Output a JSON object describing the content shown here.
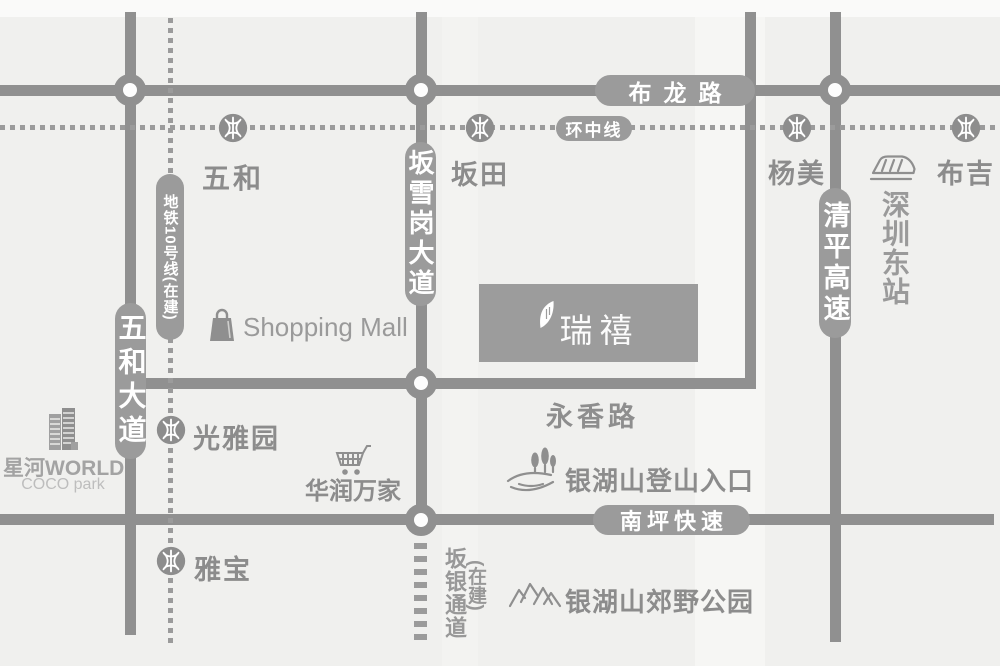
{
  "colors": {
    "background": "#f0f0ee",
    "road": "#909090",
    "pill_background": "#9b9b9b",
    "map_text": "#8c8c8c",
    "light_text": "#bdbdbd",
    "project_box": "#9c9c9c",
    "label_text_on_road": "#ffffff"
  },
  "roads": {
    "bulong": "布龙路",
    "huanzhong": "环中线",
    "yongxiang": "永香路",
    "nanping": "南坪快速",
    "wuhe_avenue": "五和大道",
    "banxuegang": "坂雪岗大道",
    "qingping": "清平高速",
    "metro10": "地铁10号线(在建)",
    "banyin": "坂银通道",
    "banyin_status": "(在建)"
  },
  "stations": {
    "wuhe": "五和",
    "bantian": "坂田",
    "yangmei": "杨美",
    "buji": "布吉",
    "guangyayuan": "光雅园",
    "yabao": "雅宝",
    "shenzhen_east": "深圳东站"
  },
  "pois": {
    "shopping_mall": "Shopping Mall",
    "xinghe_world": "星河WORLD",
    "coco_park": "COCO park",
    "huarun": "华润万家",
    "hiking_entrance": "银湖山登山入口",
    "country_park": "银湖山郊野公园"
  },
  "project": {
    "logo_text": "瑞禧"
  }
}
